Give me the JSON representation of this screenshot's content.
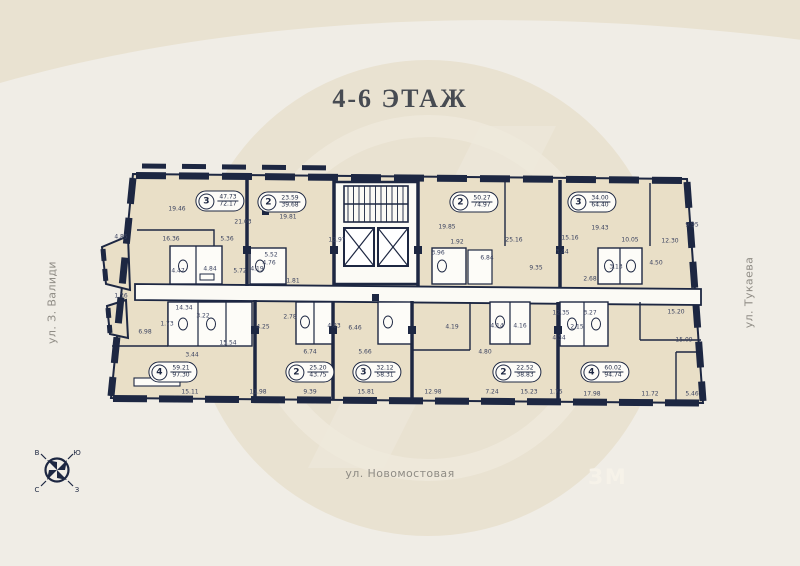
{
  "page": {
    "title": "4-6 ЭТАЖ"
  },
  "streets": {
    "left": "ул. З. Валиди",
    "right": "ул. Тукаева",
    "bottom": "ул. Новомостовая"
  },
  "compass": {
    "letters": [
      "В",
      "Ю",
      "С",
      "З"
    ]
  },
  "watermark": {
    "logo_text": "ЗМ"
  },
  "colors": {
    "background": "#f0ede6",
    "watermark": "#e9e2d1",
    "wall": "#1d2742",
    "floor": "#e9dfc7",
    "common_area": "#fbfaf5",
    "accent_text": "#474b52",
    "street_text": "#8f8c85",
    "dimension_text": "#3b4360"
  },
  "apartments": [
    {
      "rooms": "3",
      "area_top": "47.73",
      "area_bottom": "72.17",
      "x": 220,
      "y": 201
    },
    {
      "rooms": "2",
      "area_top": "23.59",
      "area_bottom": "39.68",
      "x": 282,
      "y": 202
    },
    {
      "rooms": "2",
      "area_top": "50.27",
      "area_bottom": "74.97",
      "x": 474,
      "y": 202
    },
    {
      "rooms": "3",
      "area_top": "34.00",
      "area_bottom": "64.40",
      "x": 592,
      "y": 202
    },
    {
      "rooms": "4",
      "area_top": "59.21",
      "area_bottom": "97.30",
      "x": 173,
      "y": 372
    },
    {
      "rooms": "2",
      "area_top": "25.20",
      "area_bottom": "43.75",
      "x": 310,
      "y": 372
    },
    {
      "rooms": "3",
      "area_top": "32.12",
      "area_bottom": "58.31",
      "x": 377,
      "y": 372
    },
    {
      "rooms": "2",
      "area_top": "22.52",
      "area_bottom": "38.83",
      "x": 517,
      "y": 372
    },
    {
      "rooms": "4",
      "area_top": "60.02",
      "area_bottom": "94.74",
      "x": 605,
      "y": 372
    }
  ],
  "dimensions": [
    {
      "v": "19.46",
      "x": 177,
      "y": 209
    },
    {
      "v": "21.03",
      "x": 243,
      "y": 222
    },
    {
      "v": "16.36",
      "x": 171,
      "y": 239
    },
    {
      "v": "5.36",
      "x": 227,
      "y": 239
    },
    {
      "v": "4.85",
      "x": 121,
      "y": 237
    },
    {
      "v": "4.47",
      "x": 178,
      "y": 271
    },
    {
      "v": "4.84",
      "x": 210,
      "y": 269
    },
    {
      "v": "5.72",
      "x": 240,
      "y": 271
    },
    {
      "v": "19.81",
      "x": 288,
      "y": 217
    },
    {
      "v": "12.97",
      "x": 337,
      "y": 240
    },
    {
      "v": "5.52",
      "x": 271,
      "y": 255
    },
    {
      "v": "4.19",
      "x": 257,
      "y": 269
    },
    {
      "v": "4.76",
      "x": 269,
      "y": 263
    },
    {
      "v": "1.81",
      "x": 293,
      "y": 281
    },
    {
      "v": "19.85",
      "x": 447,
      "y": 227
    },
    {
      "v": "25.16",
      "x": 514,
      "y": 240
    },
    {
      "v": "15.16",
      "x": 570,
      "y": 238
    },
    {
      "v": "3.96",
      "x": 438,
      "y": 253
    },
    {
      "v": "1.92",
      "x": 457,
      "y": 242
    },
    {
      "v": "6.84",
      "x": 487,
      "y": 258
    },
    {
      "v": "9.35",
      "x": 536,
      "y": 268
    },
    {
      "v": "3.44",
      "x": 562,
      "y": 252
    },
    {
      "v": "2.68",
      "x": 590,
      "y": 279
    },
    {
      "v": "19.43",
      "x": 600,
      "y": 228
    },
    {
      "v": "10.05",
      "x": 630,
      "y": 240
    },
    {
      "v": "12.30",
      "x": 670,
      "y": 241
    },
    {
      "v": "3.13",
      "x": 616,
      "y": 267
    },
    {
      "v": "4.50",
      "x": 656,
      "y": 263
    },
    {
      "v": "9.95",
      "x": 692,
      "y": 225
    },
    {
      "v": "1.36",
      "x": 121,
      "y": 296
    },
    {
      "v": "14.34",
      "x": 184,
      "y": 308
    },
    {
      "v": "1.73",
      "x": 167,
      "y": 324
    },
    {
      "v": "3.22",
      "x": 203,
      "y": 316
    },
    {
      "v": "6.98",
      "x": 145,
      "y": 332
    },
    {
      "v": "15.54",
      "x": 228,
      "y": 343
    },
    {
      "v": "3.44",
      "x": 192,
      "y": 355
    },
    {
      "v": "15.11",
      "x": 190,
      "y": 392
    },
    {
      "v": "11.98",
      "x": 258,
      "y": 392
    },
    {
      "v": "2.78",
      "x": 290,
      "y": 317
    },
    {
      "v": "4.25",
      "x": 263,
      "y": 327
    },
    {
      "v": "6.74",
      "x": 310,
      "y": 352
    },
    {
      "v": "9.39",
      "x": 310,
      "y": 392
    },
    {
      "v": "4.83",
      "x": 334,
      "y": 326
    },
    {
      "v": "6.46",
      "x": 355,
      "y": 328
    },
    {
      "v": "5.66",
      "x": 365,
      "y": 352
    },
    {
      "v": "15.81",
      "x": 366,
      "y": 392
    },
    {
      "v": "4.19",
      "x": 452,
      "y": 327
    },
    {
      "v": "4.14",
      "x": 497,
      "y": 326
    },
    {
      "v": "4.16",
      "x": 520,
      "y": 326
    },
    {
      "v": "4.80",
      "x": 485,
      "y": 352
    },
    {
      "v": "12.98",
      "x": 433,
      "y": 392
    },
    {
      "v": "7.24",
      "x": 492,
      "y": 392
    },
    {
      "v": "15.23",
      "x": 529,
      "y": 392
    },
    {
      "v": "1.75",
      "x": 556,
      "y": 392
    },
    {
      "v": "12.35",
      "x": 561,
      "y": 313
    },
    {
      "v": "3.27",
      "x": 590,
      "y": 313
    },
    {
      "v": "2.15",
      "x": 577,
      "y": 327
    },
    {
      "v": "4.34",
      "x": 559,
      "y": 338
    },
    {
      "v": "15.20",
      "x": 676,
      "y": 312
    },
    {
      "v": "15.09",
      "x": 684,
      "y": 340
    },
    {
      "v": "17.98",
      "x": 592,
      "y": 394
    },
    {
      "v": "11.72",
      "x": 650,
      "y": 394
    },
    {
      "v": "5.46",
      "x": 692,
      "y": 394
    }
  ]
}
